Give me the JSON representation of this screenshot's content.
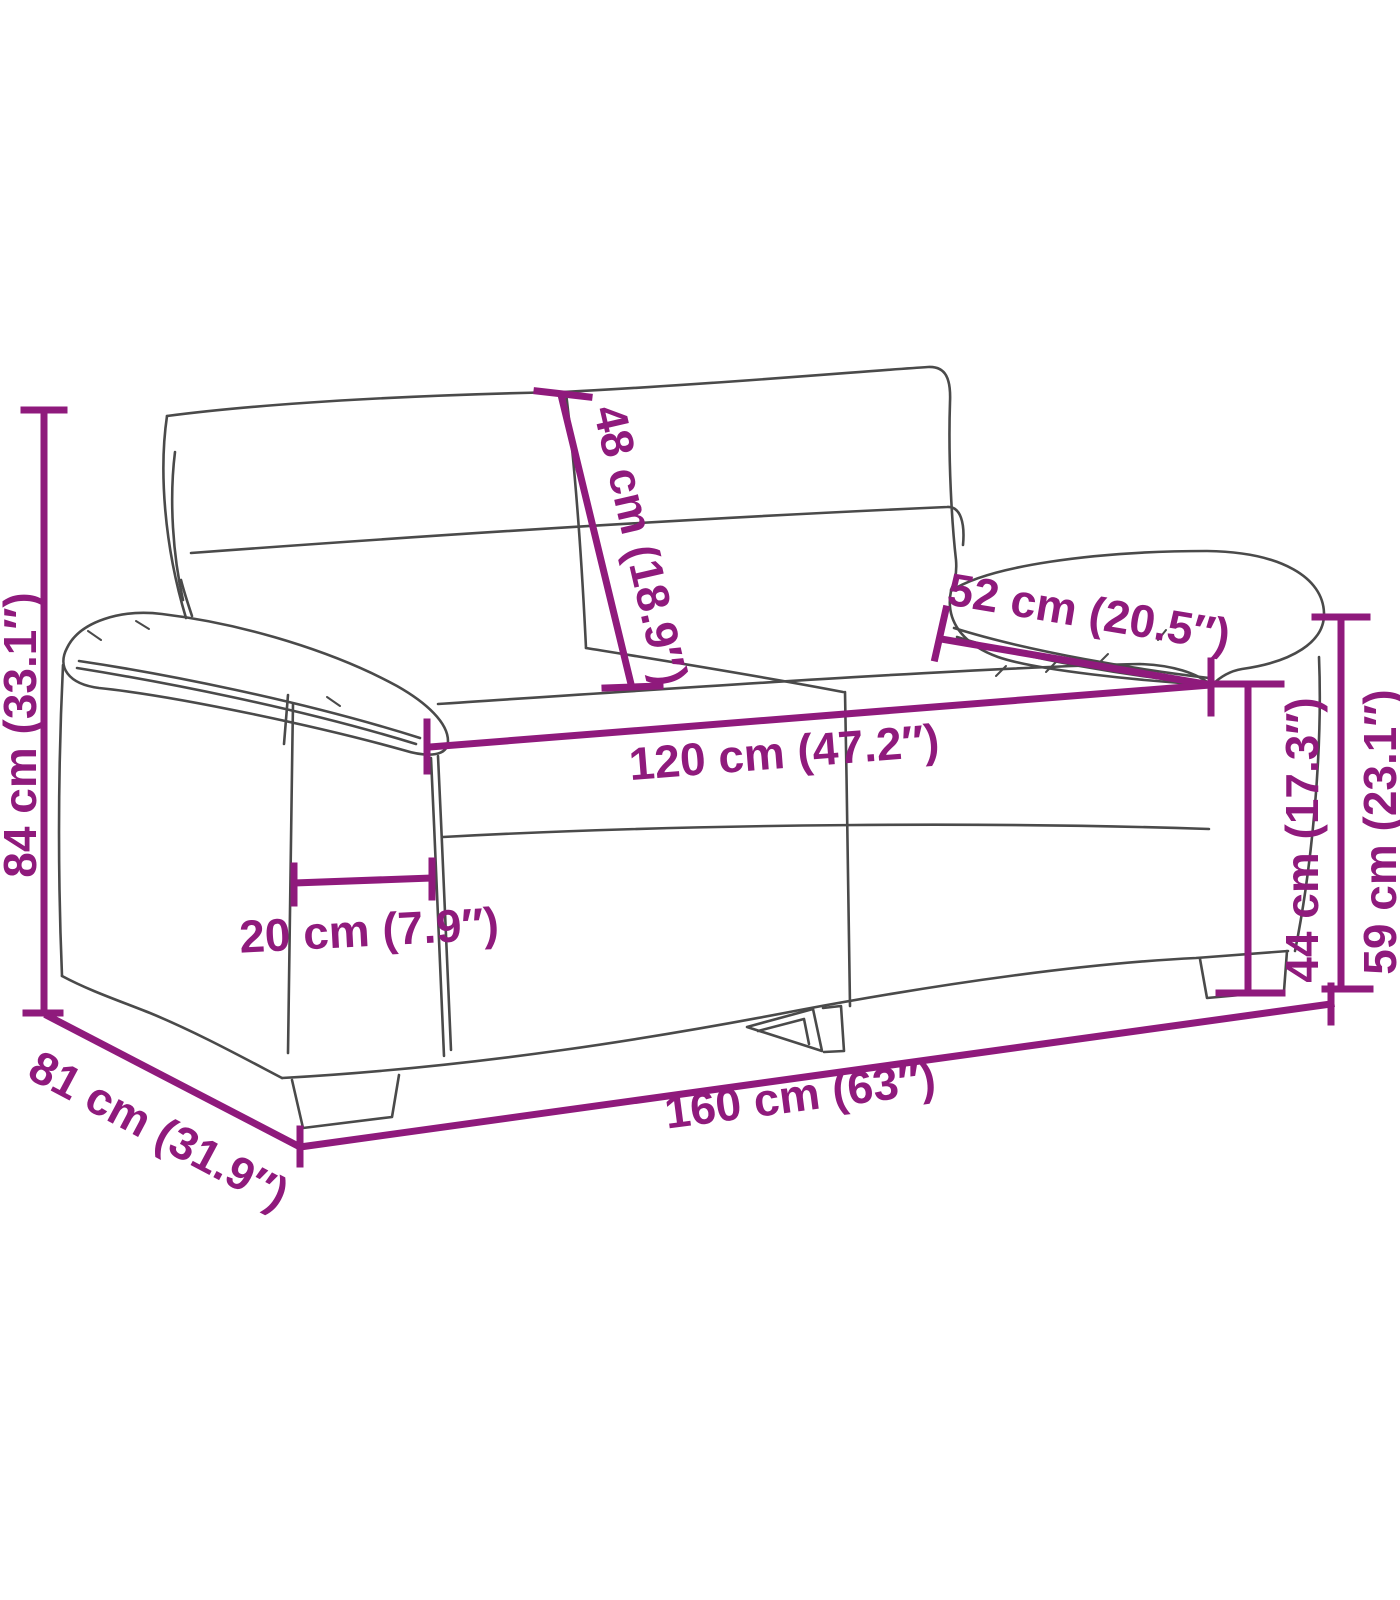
{
  "diagram": {
    "subject": "2-seater sofa dimension line drawing",
    "colors": {
      "dimension_accent": "#8F1A7C",
      "sofa_outline": "#4A4A4A",
      "background": "#FFFFFF"
    },
    "dimensions": [
      {
        "id": "overall-height",
        "label": "84 cm (33.1″)",
        "value_cm": "84 cm",
        "value_in": "33.1″"
      },
      {
        "id": "backrest-height",
        "label": "48 cm (18.9″)",
        "value_cm": "48 cm",
        "value_in": "18.9″"
      },
      {
        "id": "armrest-depth",
        "label": "52 cm (20.5″)",
        "value_cm": "52 cm",
        "value_in": "20.5″"
      },
      {
        "id": "seat-width",
        "label": "120 cm (47.2″)",
        "value_cm": "120 cm",
        "value_in": "47.2″"
      },
      {
        "id": "armrest-width",
        "label": "20 cm (7.9″)",
        "value_cm": "20 cm",
        "value_in": "7.9″"
      },
      {
        "id": "overall-depth",
        "label": "81 cm (31.9″)",
        "value_cm": "81 cm",
        "value_in": "31.9″"
      },
      {
        "id": "overall-width",
        "label": "160 cm (63″)",
        "value_cm": "160 cm",
        "value_in": "63″"
      },
      {
        "id": "seat-height",
        "label": "44 cm (17.3″)",
        "value_cm": "44 cm",
        "value_in": "17.3″"
      },
      {
        "id": "armrest-height",
        "label": "59 cm (23.1″)",
        "value_cm": "59 cm",
        "value_in": "23.1″"
      }
    ]
  }
}
